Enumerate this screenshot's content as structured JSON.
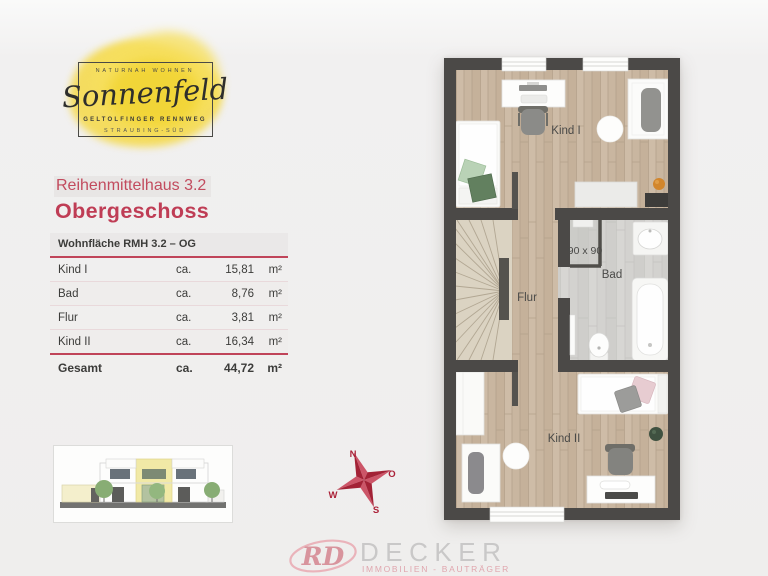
{
  "logo": {
    "tagline": "NATURNAH WOHNEN",
    "name": "Sonnenfeld",
    "street": "GELTOLFINGER RENNWEG",
    "district": "STRAUBING-SÜD",
    "blob_color": "#f5d946"
  },
  "header": {
    "project": "Reihenmittelhaus 3.2",
    "floor": "Obergeschoss",
    "accent_color": "#c04459"
  },
  "area_table": {
    "title": "Wohnfläche RMH 3.2 – OG",
    "rows": [
      {
        "room": "Kind I",
        "approx": "ca.",
        "value": "15,81",
        "unit": "m²"
      },
      {
        "room": "Bad",
        "approx": "ca.",
        "value": "8,76",
        "unit": "m²"
      },
      {
        "room": "Flur",
        "approx": "ca.",
        "value": "3,81",
        "unit": "m²"
      },
      {
        "room": "Kind II",
        "approx": "ca.",
        "value": "16,34",
        "unit": "m²"
      }
    ],
    "total": {
      "room": "Gesamt",
      "approx": "ca.",
      "value": "44,72",
      "unit": "m²"
    }
  },
  "floorplan": {
    "labels": {
      "kind1": "Kind I",
      "bad": "Bad",
      "flur": "Flur",
      "kind2": "Kind II",
      "shower": "90 x 90"
    },
    "wall_color": "#4b4947",
    "wood_color": "#c9b6a0",
    "tile_color": "#d3d2cf"
  },
  "compass": {
    "north": "N",
    "east": "O",
    "south": "S",
    "west": "W",
    "color": "#ab2138"
  },
  "footer": {
    "monogram": "RD",
    "company": "DECKER",
    "tagline": "IMMOBILIEN - BAUTRÄGER",
    "pink": "#e0a6ae"
  }
}
